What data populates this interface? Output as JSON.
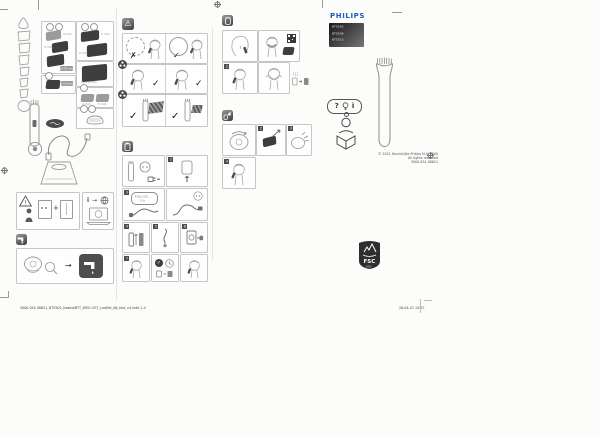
{
  "brand": {
    "logo": "PHILIPS",
    "logo_color": "#1f5bb5",
    "models": [
      "BT5502",
      "BT5509",
      "BT5515"
    ]
  },
  "copyright": {
    "line1": "© 2021 Koninklijke Philips N.V. 3000",
    "line2": "All rights reserved",
    "line3": "3000 054 08621"
  },
  "footer": {
    "left": "3000 054 08621_BT5502_Naked/BTT_WEU LFLT_Leaflet_A8_fold_v4.indd 1-4",
    "right": "26-04-21 15:37"
  },
  "fsc": {
    "acronym": "FSC",
    "label": "MIX"
  },
  "help_bubble": {
    "question": "?",
    "info": "i"
  },
  "charge_bubble": {
    "line1": "FULL CH.",
    "line2": "3 h"
  },
  "marks": {
    "check": "✓",
    "cross": "✗",
    "warning": "⚠",
    "arrow": "→",
    "plus": "+",
    "info": "i",
    "exclaim": "!"
  },
  "steps": {
    "s2": "2",
    "s3": "3",
    "s4": "4",
    "s5": "5",
    "s6": "6",
    "s7": "7"
  },
  "usage": {
    "s2": "2"
  },
  "maint": {
    "s2": "2",
    "s3": "3",
    "s4": "4"
  },
  "parts": {
    "a_label1": "3 mm",
    "a_label2": "5 mm",
    "a_chip": "10-20 mm",
    "a2_chip": "5-10 mm",
    "b_label1": "1 mm",
    "b_label2": "2 mm",
    "b_label3": "3 mm",
    "b2_label": "10-20 mm",
    "b3_label1": "4 mm",
    "b3_label2": "5 mm"
  }
}
